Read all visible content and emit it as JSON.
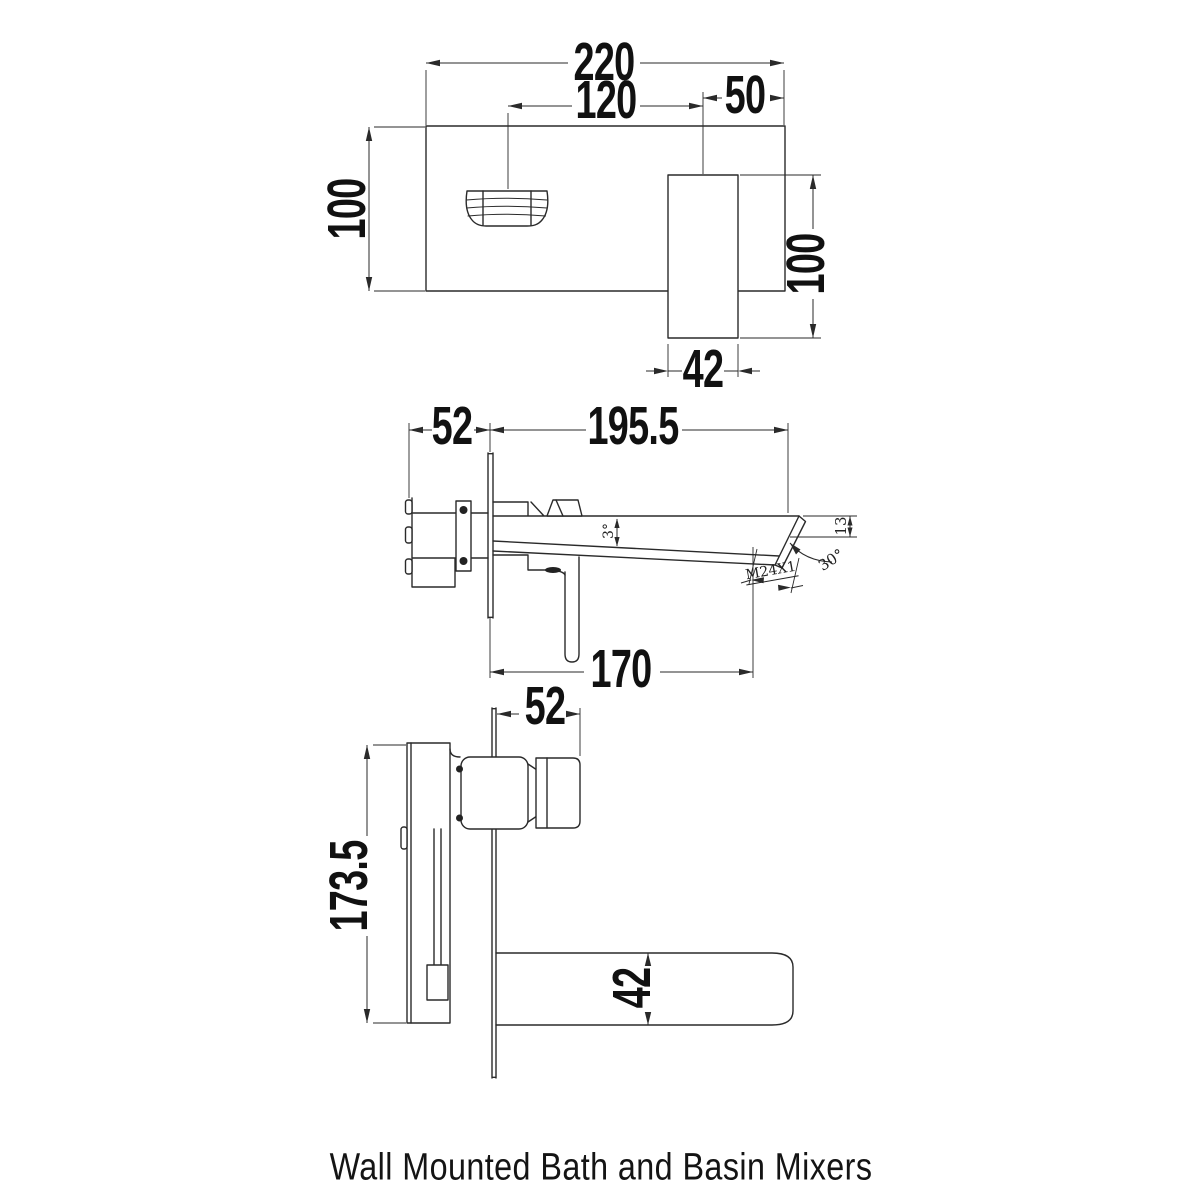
{
  "page": {
    "caption": "Wall Mounted Bath and  Basin Mixers",
    "background_color": "#ffffff",
    "line_color": "#2a2a2a",
    "text_color": "#111111"
  },
  "views": {
    "front": {
      "name": "front-elevation",
      "dims": {
        "overall_width": "220",
        "spout_center_offset": "120",
        "handle_center_offset": "50",
        "plate_height": "100",
        "handle_length": "100",
        "handle_width": "42"
      }
    },
    "side": {
      "name": "side-elevation",
      "dims": {
        "wall_body_depth": "52",
        "spout_reach": "195.5",
        "spout_length": "170",
        "spout_taper_angle": "3°",
        "tip_height": "13",
        "tip_cut_angle": "30°",
        "aerator_thread": "M24X1"
      }
    },
    "plan": {
      "name": "plan-view",
      "dims": {
        "projection_depth": "52",
        "concealed_body_height": "173.5",
        "spout_width": "42"
      }
    }
  }
}
